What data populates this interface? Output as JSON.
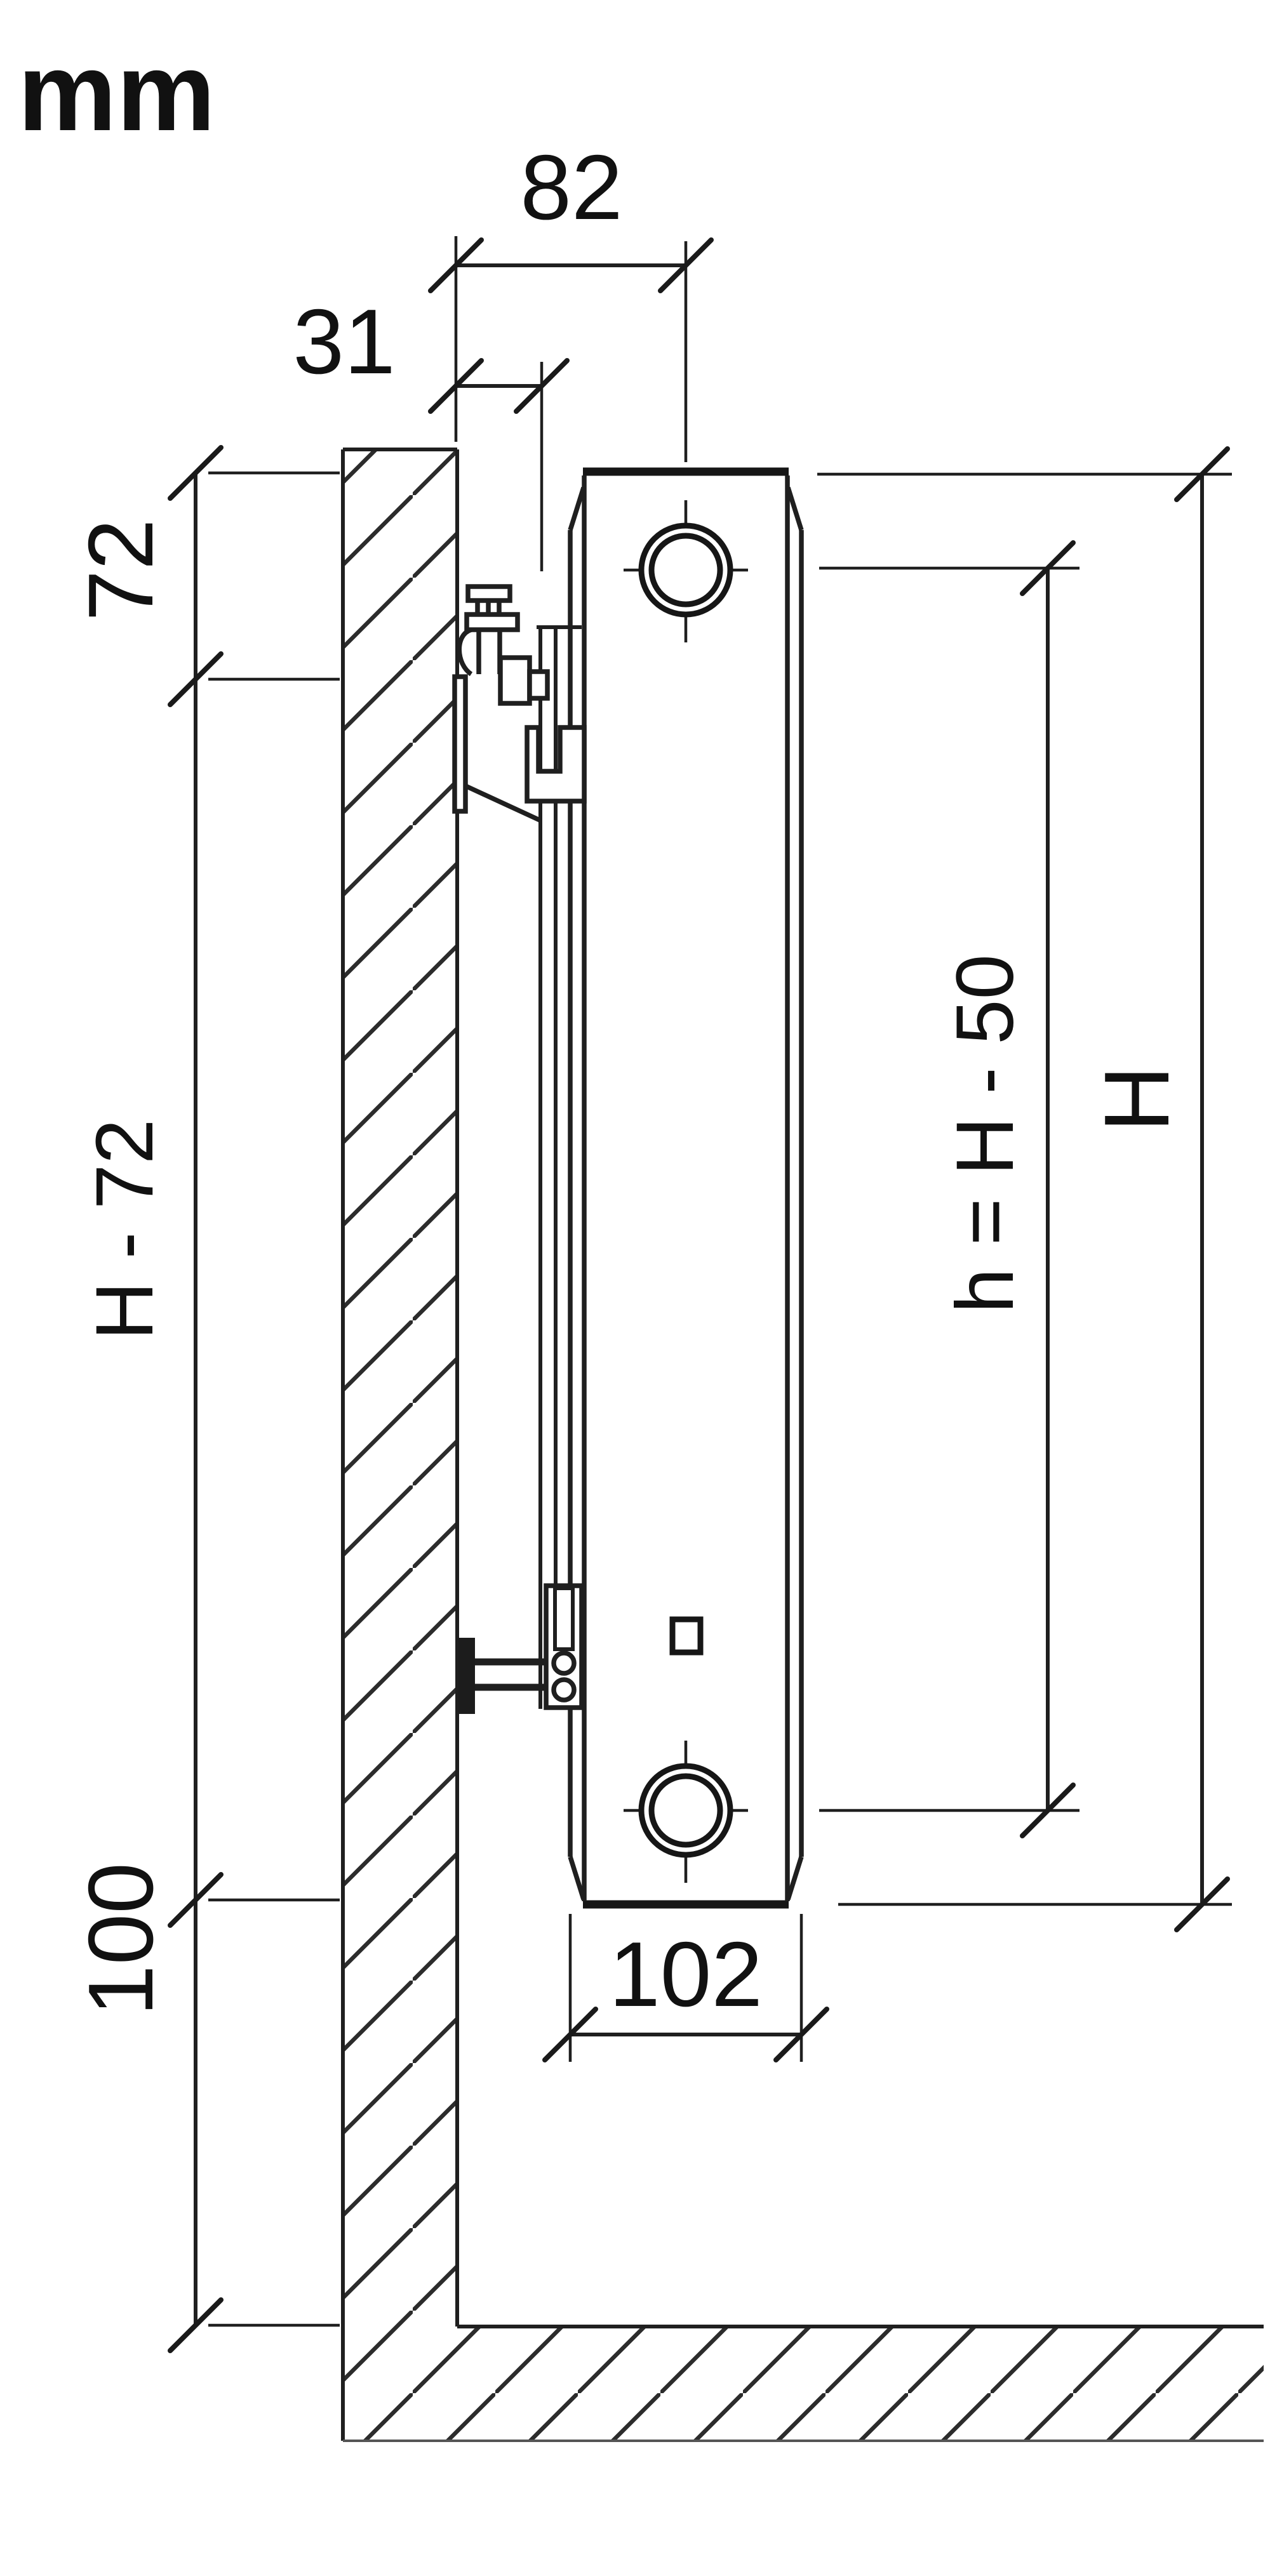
{
  "diagram": {
    "unit_label": "mm",
    "type": "radiator-wall-mounting-section",
    "dimensions": {
      "wall_to_center": "82",
      "wall_to_bracket": "31",
      "top_to_valve_center": "72",
      "valve_center_to_bottom": "H - 72",
      "floor_clearance": "100",
      "port_axis_spacing": "h = H - 50",
      "total_height": "H",
      "depth": "102"
    },
    "colors": {
      "line": "#1f1f1f",
      "background": "#ffffff"
    }
  }
}
